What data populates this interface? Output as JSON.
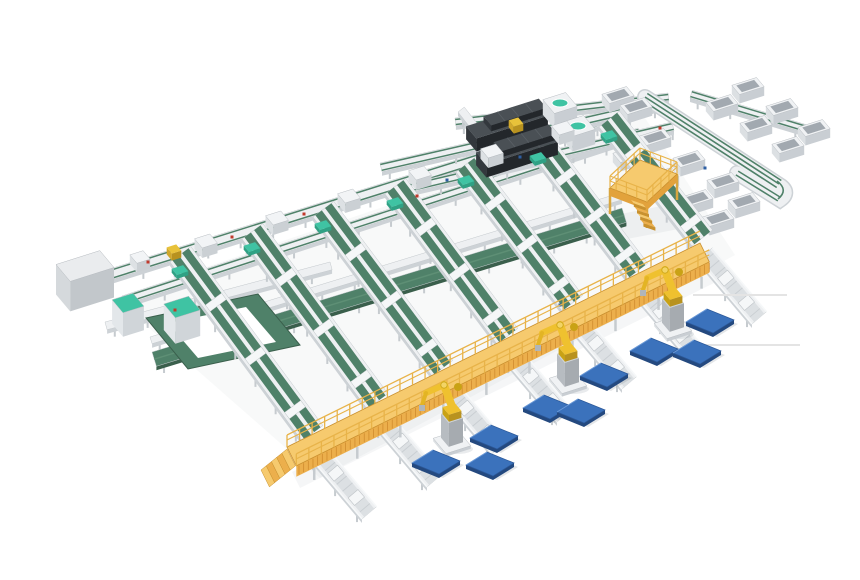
{
  "meta": {
    "description": "3D isometric render of an automated parcel sortation and palletizing facility with green belt conveyors, telescopic unloaders, scanner stations, a yellow mezzanine platform and walkway, palletizing robots and blue pallets"
  },
  "colors": {
    "background": "#ffffff",
    "belt_green": "#4F8169",
    "belt_green_dark": "#3A5F4C",
    "belt_green_light": "#5E8F75",
    "frame_white": "#EEF0F2",
    "frame_bed": "#DCE0E3",
    "frame_dark": "#C3C8CC",
    "frame_side": "#CDD2D6",
    "leg_gray": "#C6CBCF",
    "teal": "#3FC3A3",
    "teal_dark": "#2FA184",
    "walkway_deck": "#F6CA6E",
    "walkway_face": "#ECAF4C",
    "walkway_slat": "#D08C2E",
    "walkway_rail": "#E8B349",
    "walkway_outline": "#C98F2E",
    "walkway_skirt": "#E2A23C",
    "robot_yellow": "#EFC12F",
    "robot_shade": "#C9A215",
    "robot_joint": "#F3D465",
    "pallet_top": "#3B72BC",
    "pallet_side": "#24497F",
    "pallet_edge": "#2B5899",
    "pallet_hi": "#6C9BD9",
    "loader_top": "#4A5055",
    "loader_left": "#33383D",
    "loader_front": "#23272B",
    "cabinet_top": "#EAECEE",
    "cabinet_left": "#D5D9DC",
    "cabinet_front": "#C2C7CB",
    "bin_cavity": "#A2A9B0",
    "accent_red": "#C0392B",
    "accent_blue": "#2E5FA3",
    "parcel_yellow": "#E8C23A",
    "shadow": "rgba(120,130,142,1)",
    "leader": "#E4E4E4"
  },
  "scene": {
    "canvas": {
      "w": 860,
      "h": 580
    },
    "shadows": [
      {
        "pts": [
          [
            115,
            298
          ],
          [
            645,
            118
          ],
          [
            735,
            255
          ],
          [
            320,
            478
          ]
        ],
        "o": 0.05
      },
      {
        "pts": [
          [
            292,
            472
          ],
          [
            708,
            266
          ],
          [
            716,
            282
          ],
          [
            300,
            488
          ]
        ],
        "o": 0.07
      },
      {
        "pts": [
          [
            610,
            216
          ],
          [
            682,
            202
          ],
          [
            694,
            226
          ],
          [
            622,
            240
          ]
        ],
        "o": 0.08
      }
    ],
    "ne_lanes": [
      {
        "name": "main-sorter-line-a",
        "kind": "trunk",
        "r": [
          100,
          272,
          660,
          96,
          11
        ]
      },
      {
        "name": "main-sorter-line-b",
        "kind": "trunk",
        "r": [
          122,
          296,
          638,
          128,
          9
        ]
      },
      {
        "name": "collector-line",
        "kind": "white",
        "r": [
          150,
          337,
          620,
          193,
          7
        ]
      },
      {
        "name": "merge-belt",
        "kind": "green",
        "r": [
          152,
          352,
          622,
          208,
          15
        ]
      },
      {
        "name": "top-return-segment",
        "kind": "trunk",
        "r": [
          455,
          118,
          668,
          93,
          8
        ]
      },
      {
        "name": "link-lane",
        "kind": "white",
        "r": [
          458,
          112,
          494,
          158,
          8
        ]
      },
      {
        "name": "feed-line-1",
        "kind": "trunk",
        "r": [
          380,
          163,
          655,
          100,
          9
        ]
      },
      {
        "name": "feed-line-2",
        "kind": "trunk",
        "r": [
          398,
          186,
          672,
          122,
          9
        ]
      },
      {
        "name": "outfeed-spur",
        "kind": "trunk",
        "r": [
          690,
          98,
          806,
          133,
          8
        ]
      },
      {
        "name": "cabinet-line",
        "kind": "white",
        "r": [
          105,
          322,
          330,
          262,
          8
        ]
      }
    ],
    "loop_ring": {
      "outer": [
        [
          146,
          318
        ],
        [
          258,
          294
        ],
        [
          300,
          345
        ],
        [
          188,
          369
        ]
      ],
      "inner": [
        [
          168,
          323
        ],
        [
          246,
          307
        ],
        [
          276,
          342
        ],
        [
          198,
          358
        ]
      ]
    },
    "chutes": {
      "w": 26,
      "runs": [
        [
          170,
          262,
          302,
          441
        ],
        [
          242,
          239,
          367,
          409
        ],
        [
          313,
          217,
          432,
          376
        ],
        [
          385,
          194,
          497,
          344
        ],
        [
          456,
          172,
          562,
          311
        ],
        [
          528,
          149,
          627,
          279
        ],
        [
          599,
          127,
          692,
          246
        ]
      ]
    },
    "out_lanes": {
      "w": 19,
      "runs": [
        [
          308,
          455,
          362,
          519
        ],
        [
          373,
          423,
          427,
          487
        ],
        [
          438,
          390,
          492,
          454
        ],
        [
          503,
          358,
          557,
          422
        ],
        [
          568,
          325,
          622,
          389
        ],
        [
          633,
          293,
          687,
          357
        ],
        [
          698,
          260,
          752,
          324
        ]
      ]
    },
    "return_line": {
      "main": [
        645,
        100,
        779,
        187
      ],
      "back": [
        779,
        199,
        737,
        173
      ]
    },
    "boxes": [
      {
        "name": "control-cabinet",
        "kind": "cabinet",
        "c": [
          85,
          296
        ],
        "s": [
          46,
          22,
          30
        ]
      },
      {
        "name": "tote-cabinet",
        "kind": "teal",
        "c": [
          128,
          327
        ],
        "s": [
          22,
          17,
          24
        ]
      },
      {
        "name": "tote-cabinet",
        "kind": "teal",
        "c": [
          182,
          333
        ],
        "s": [
          26,
          18,
          26
        ]
      },
      {
        "name": "telescopic-loader",
        "kind": "loader",
        "c": [
          507,
          134
        ],
        "s": [
          75,
          16,
          13
        ]
      },
      {
        "name": "telescopic-loader-top",
        "kind": "loader",
        "c": [
          515,
          131
        ],
        "s": [
          58,
          12,
          6
        ],
        "lift": 13
      },
      {
        "name": "telescopic-loader",
        "kind": "loader",
        "c": [
          517,
          160
        ],
        "s": [
          75,
          16,
          13
        ]
      },
      {
        "name": "telescopic-loader-top",
        "kind": "loader",
        "c": [
          525,
          157
        ],
        "s": [
          58,
          12,
          6
        ],
        "lift": 13
      },
      {
        "name": "dws-scanner",
        "kind": "dws",
        "c": [
          560,
          118
        ],
        "s": [
          24,
          18,
          15
        ]
      },
      {
        "name": "dws-scanner",
        "kind": "dws",
        "c": [
          578,
          141
        ],
        "s": [
          24,
          18,
          15
        ]
      },
      {
        "name": "induction-unit",
        "kind": "induction",
        "c": [
          206,
          251
        ],
        "s": [
          16,
          12,
          10
        ]
      },
      {
        "name": "induction-unit",
        "kind": "induction",
        "c": [
          277,
          228
        ],
        "s": [
          16,
          12,
          10
        ]
      },
      {
        "name": "induction-unit",
        "kind": "induction",
        "c": [
          349,
          206
        ],
        "s": [
          16,
          12,
          10
        ]
      },
      {
        "name": "induction-unit",
        "kind": "induction",
        "c": [
          420,
          183
        ],
        "s": [
          16,
          12,
          10
        ]
      },
      {
        "name": "induction-unit",
        "kind": "induction",
        "c": [
          492,
          161
        ],
        "s": [
          16,
          12,
          10
        ]
      },
      {
        "name": "induction-unit",
        "kind": "induction",
        "c": [
          563,
          138
        ],
        "s": [
          16,
          12,
          10
        ]
      },
      {
        "name": "induction-unit",
        "kind": "induction",
        "c": [
          140,
          266
        ],
        "s": [
          14,
          11,
          9
        ]
      },
      {
        "name": "parcel",
        "kind": "parcel",
        "c": [
          174,
          256
        ],
        "s": [
          10,
          8,
          7
        ]
      },
      {
        "name": "parcel",
        "kind": "parcel",
        "c": [
          516,
          129
        ],
        "s": [
          10,
          8,
          7
        ]
      },
      {
        "name": "chute-cap",
        "kind": "tealcap",
        "c": [
          180,
          274
        ],
        "s": [
          12,
          8,
          4
        ]
      },
      {
        "name": "chute-cap",
        "kind": "tealcap",
        "c": [
          252,
          251
        ],
        "s": [
          12,
          8,
          4
        ]
      },
      {
        "name": "chute-cap",
        "kind": "tealcap",
        "c": [
          323,
          229
        ],
        "s": [
          12,
          8,
          4
        ]
      },
      {
        "name": "chute-cap",
        "kind": "tealcap",
        "c": [
          395,
          206
        ],
        "s": [
          12,
          8,
          4
        ]
      },
      {
        "name": "chute-cap",
        "kind": "tealcap",
        "c": [
          466,
          184
        ],
        "s": [
          12,
          8,
          4
        ]
      },
      {
        "name": "chute-cap",
        "kind": "tealcap",
        "c": [
          538,
          161
        ],
        "s": [
          12,
          8,
          4
        ]
      },
      {
        "name": "chute-cap",
        "kind": "tealcap",
        "c": [
          609,
          139
        ],
        "s": [
          12,
          8,
          4
        ]
      }
    ],
    "bins": [
      [
        655,
        146
      ],
      [
        629,
        163
      ],
      [
        689,
        168
      ],
      [
        663,
        185
      ],
      [
        723,
        190
      ],
      [
        697,
        207
      ],
      [
        744,
        210
      ],
      [
        718,
        227
      ],
      [
        722,
        112
      ],
      [
        748,
        95
      ],
      [
        756,
        133
      ],
      [
        782,
        116
      ],
      [
        788,
        154
      ],
      [
        814,
        137
      ],
      [
        618,
        104
      ],
      [
        636,
        115
      ]
    ],
    "pallets": [
      [
        436,
        462
      ],
      [
        490,
        464
      ],
      [
        494,
        437
      ],
      [
        547,
        407
      ],
      [
        581,
        411
      ],
      [
        604,
        375
      ],
      [
        654,
        350
      ],
      [
        697,
        352
      ],
      [
        710,
        321
      ]
    ],
    "robots": [
      [
        452,
        445
      ],
      [
        568,
        385
      ],
      [
        673,
        330
      ]
    ],
    "platform": {
      "deck": [
        [
          640,
          160
        ],
        [
          677,
          174
        ],
        [
          647,
          202
        ],
        [
          610,
          188
        ]
      ],
      "leg_h": 26
    },
    "walkway": {
      "run": [
        287,
        447,
        700,
        243
      ],
      "w": 21,
      "face": 11
    },
    "leaders": [
      [
        693,
        295,
        787,
        295
      ],
      [
        700,
        345,
        800,
        345
      ]
    ],
    "dots": [
      [
        148,
        262,
        "r"
      ],
      [
        232,
        237,
        "r"
      ],
      [
        304,
        214,
        "r"
      ],
      [
        417,
        196,
        "r"
      ],
      [
        660,
        128,
        "r"
      ],
      [
        175,
        310,
        "r"
      ],
      [
        447,
        180,
        "b"
      ],
      [
        520,
        157,
        "b"
      ],
      [
        705,
        168,
        "b"
      ],
      [
        560,
        305,
        "b"
      ],
      [
        495,
        352,
        "b"
      ],
      [
        430,
        378,
        "b"
      ]
    ]
  }
}
